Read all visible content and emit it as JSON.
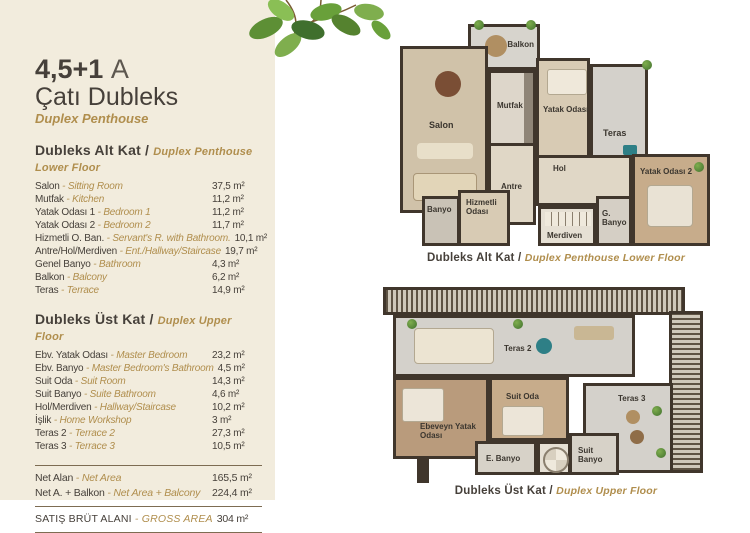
{
  "header": {
    "title_main": "4,5+1",
    "title_variant": "A",
    "title_tr": "Çatı Dubleks",
    "title_en": "Duplex Penthouse"
  },
  "colors": {
    "accent_gold": "#b08e4d",
    "text_dark": "#46403a",
    "panel_bg": "#f2ecdd",
    "wall_dark": "#40362c"
  },
  "lower_floor": {
    "header_tr": "Dubleks Alt Kat /",
    "header_en": "Duplex Penthouse Lower Floor",
    "rows": [
      {
        "tr": "Salon",
        "en": "Sitting Room",
        "area": "37,5 m²"
      },
      {
        "tr": "Mutfak",
        "en": "Kitchen",
        "area": "11,2 m²"
      },
      {
        "tr": "Yatak Odası 1",
        "en": "Bedroom 1",
        "area": "11,2 m²"
      },
      {
        "tr": "Yatak Odası 2",
        "en": "Bedroom 2",
        "area": "11,7 m²"
      },
      {
        "tr": "Hizmetli O. Ban.",
        "en": "Servant's R. with Bathroom.",
        "area": "10,1 m²"
      },
      {
        "tr": "Antre/Hol/Merdiven",
        "en": "Ent./Hallway/Staircase",
        "area": "19,7 m²"
      },
      {
        "tr": "Genel Banyo",
        "en": "Bathroom",
        "area": "4,3 m²"
      },
      {
        "tr": "Balkon",
        "en": "Balcony",
        "area": "6,2 m²"
      },
      {
        "tr": "Teras",
        "en": "Terrace",
        "area": "14,9 m²"
      }
    ]
  },
  "upper_floor": {
    "header_tr": "Dubleks Üst Kat /",
    "header_en": "Duplex Upper Floor",
    "rows": [
      {
        "tr": "Ebv. Yatak Odası",
        "en": "Master Bedroom",
        "area": "23,2 m²"
      },
      {
        "tr": "Ebv. Banyo",
        "en": "Master Bedroom's Bathroom",
        "area": "4,5 m²"
      },
      {
        "tr": "Suit Oda",
        "en": "Suit Room",
        "area": "14,3 m²"
      },
      {
        "tr": "Suit Banyo",
        "en": "Suite Bathroom",
        "area": "4,6 m²"
      },
      {
        "tr": "Hol/Merdiven",
        "en": "Hallway/Staircase",
        "area": "10,2 m²"
      },
      {
        "tr": "İşlik",
        "en": "Home Workshop",
        "area": "3 m²"
      },
      {
        "tr": "Teras 2",
        "en": "Terrace 2",
        "area": "27,3 m²"
      },
      {
        "tr": "Teras 3",
        "en": "Terrace 3",
        "area": "10,5 m²"
      }
    ]
  },
  "totals": {
    "rows": [
      {
        "tr": "Net Alan",
        "en": "Net Area",
        "area": "165,5 m²"
      },
      {
        "tr": "Net A. + Balkon",
        "en": "Net Area + Balcony",
        "area": "224,4 m²"
      }
    ],
    "gross": {
      "tr": "SATIŞ BRÜT ALANI",
      "en": "GROSS AREA",
      "area": "304 m²"
    }
  },
  "plan_lower": {
    "caption_tr": "Dubleks Alt Kat /",
    "caption_en": "Duplex Penthouse Lower Floor",
    "rooms": {
      "balkon": "Balkon",
      "salon": "Salon",
      "mutfak": "Mutfak",
      "yatak1": "Yatak Odası 1",
      "teras": "Teras",
      "hol": "Hol",
      "antre": "Antre",
      "banyo": "Banyo",
      "hizmetli": "Hizmetli Odası",
      "merdiven": "Merdiven",
      "gbanyo": "G. Banyo",
      "yatak2": "Yatak Odası 2"
    }
  },
  "plan_upper": {
    "caption_tr": "Dubleks Üst Kat /",
    "caption_en": "Duplex Upper Floor",
    "rooms": {
      "teras2": "Teras 2",
      "ebeveyn": "Ebeveyn Yatak Odası",
      "suitoda": "Suit Oda",
      "teras3": "Teras 3",
      "ebanyo": "E. Banyo",
      "suitbanyo": "Suit Banyo"
    }
  }
}
